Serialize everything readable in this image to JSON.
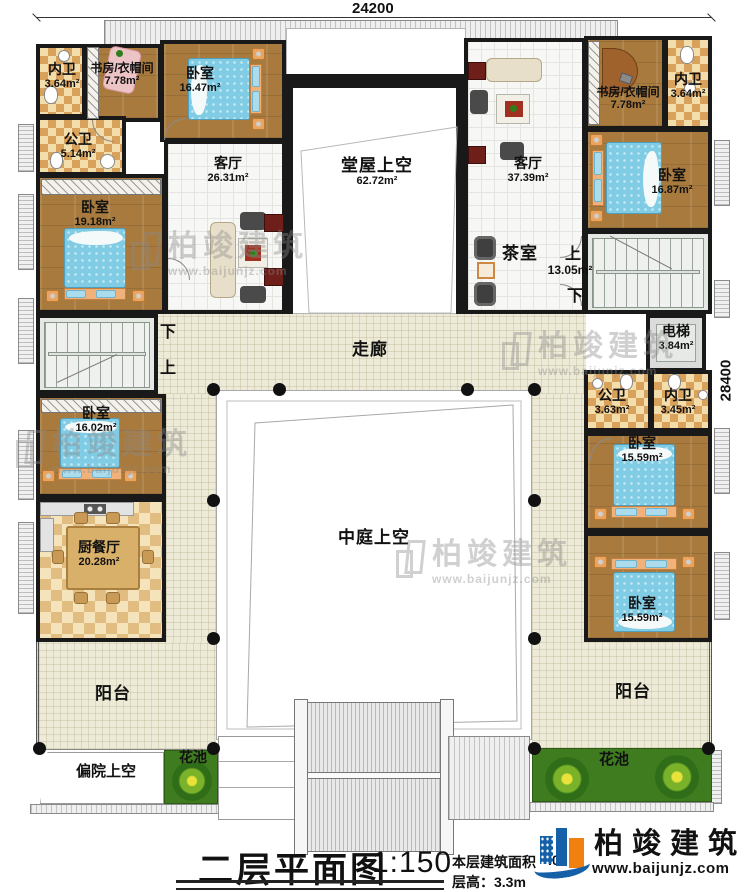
{
  "dimensions": {
    "top": "24200",
    "right": "28400"
  },
  "rooms": [
    {
      "label": "内卫",
      "area": "3.64m²"
    },
    {
      "label": "书房/衣帽间",
      "area": "7.78m²"
    },
    {
      "label": "卧室",
      "area": "16.47m²"
    },
    {
      "label": "公卫",
      "area": "5.14m²"
    },
    {
      "label": "卧室",
      "area": "19.18m²"
    },
    {
      "label": "客厅",
      "area": "26.31m²"
    },
    {
      "label": "堂屋上空",
      "area": "62.72m²"
    },
    {
      "label": "客厅",
      "area": "37.39m²"
    },
    {
      "label": "书房/衣帽间",
      "area": "7.78m²"
    },
    {
      "label": "内卫",
      "area": "3.64m²"
    },
    {
      "label": "卧室",
      "area": "16.87m²"
    },
    {
      "label": "茶室",
      "area": ""
    },
    {
      "label": "电梯",
      "area": "3.84m²"
    },
    {
      "label": "公卫",
      "area": "3.63m²"
    },
    {
      "label": "内卫",
      "area": "3.45m²"
    },
    {
      "label": "卧室",
      "area": "15.59m²"
    },
    {
      "label": "卧室",
      "area": "15.59m²"
    },
    {
      "label": "卧室",
      "area": "16.02m²"
    },
    {
      "label": "厨餐厅",
      "area": "20.28m²"
    },
    {
      "label": "中庭上空",
      "area": ""
    },
    {
      "label": "阳台",
      "area": ""
    },
    {
      "label": "阳台",
      "area": ""
    },
    {
      "label": "偏院上空",
      "area": ""
    },
    {
      "label": "花池",
      "area": ""
    },
    {
      "label": "花池",
      "area": ""
    }
  ],
  "corridor_label": "走廊",
  "stairs_right": {
    "up": "上",
    "area": "13.05m²",
    "down": "下"
  },
  "stairs_left": {
    "down": "下",
    "up": "上"
  },
  "title_block": {
    "title": "二层平面图",
    "scale": "1:150",
    "area_note": "本层建筑面积",
    "area_value_visible": ".0",
    "height_note": "层高：3.3m"
  },
  "logo": {
    "name": "柏竣建筑",
    "url": "www.baijunjz.com"
  },
  "watermark": {
    "name": "柏竣建筑",
    "url": "www.baijunjz.com"
  },
  "colors": {
    "wall": "#191919",
    "wood": "#a97a3e",
    "bath_tile": "#d9a25c",
    "corridor": "#edead7",
    "bed_blue": "#7fcce4",
    "flower_green": "#3e7c1f",
    "logo_blue": "#1660a8",
    "logo_orange": "#f08010"
  }
}
